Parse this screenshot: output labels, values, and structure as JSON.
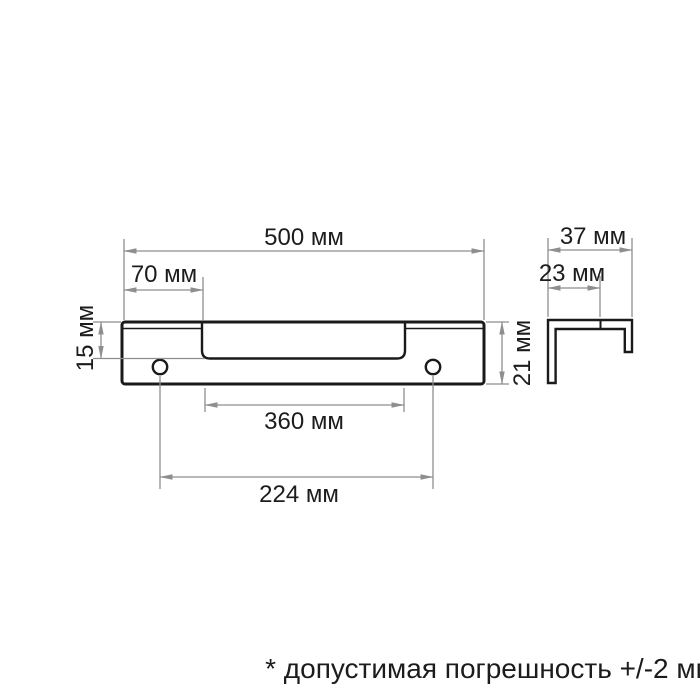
{
  "drawing": {
    "front_view": {
      "dimensions": {
        "total_width": "500 мм",
        "left_offset": "70 мм",
        "recess_depth": "15 мм",
        "total_height": "21 мм",
        "recess_width": "360 мм",
        "hole_spacing": "224 мм"
      }
    },
    "side_view": {
      "dimensions": {
        "depth": "37 мм",
        "inner_offset": "23 мм"
      }
    },
    "footnote": "* допустимая погрешность +/-2 мм",
    "colors": {
      "outline": "#1a1a1a",
      "dimension_lines": "#8e8e8e",
      "background": "#ffffff"
    },
    "units": "мм"
  }
}
